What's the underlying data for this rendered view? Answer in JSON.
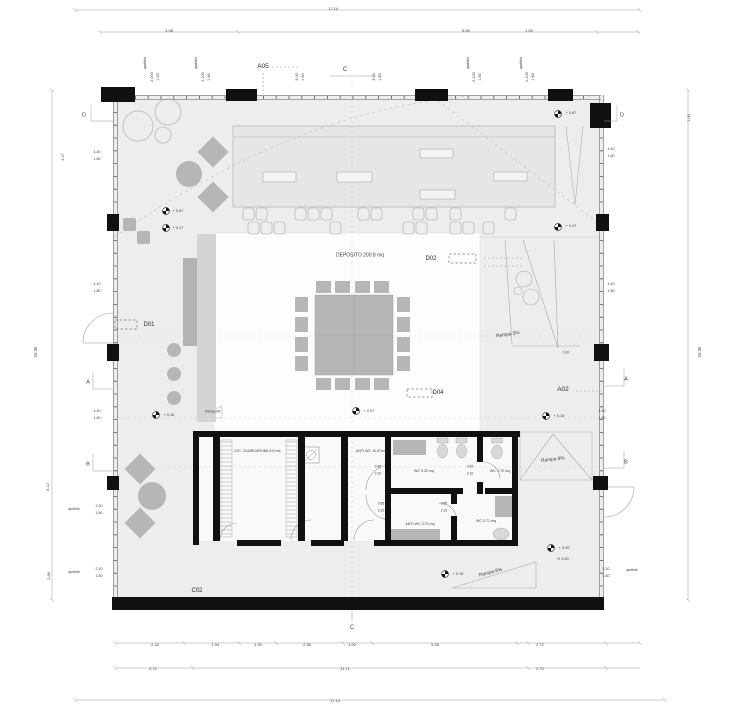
{
  "plan": {
    "colors": {
      "background": "#ffffff",
      "floor": "#ecedec",
      "wall": "#111111",
      "furniture": "#b5b7b6",
      "stage": "#e5e7e6",
      "text": "#3f3f3f"
    },
    "labels": [
      {
        "id": "dim-overall-top",
        "text": "17.14",
        "x": 333,
        "y": 9,
        "s": 4
      },
      {
        "id": "dim-top-3-08",
        "text": "3.08",
        "x": 169,
        "y": 31,
        "s": 4
      },
      {
        "id": "dim-top-8-55",
        "text": "8.55",
        "x": 466,
        "y": 31,
        "s": 4
      },
      {
        "id": "dim-top-1-00",
        "text": "1.00",
        "x": 529,
        "y": 31,
        "s": 4
      },
      {
        "id": "apribile-top-1",
        "text": "apribile",
        "x": 146,
        "y": 63,
        "s": 3.8,
        "rot": -90
      },
      {
        "id": "win-top-1a",
        "text": "2.000",
        "x": 153,
        "y": 77,
        "s": 3.8,
        "rot": -90
      },
      {
        "id": "win-top-1b",
        "text": "1.80",
        "x": 159,
        "y": 77,
        "s": 3.8,
        "rot": -90
      },
      {
        "id": "apribile-top-2",
        "text": "apribile",
        "x": 197,
        "y": 63,
        "s": 3.8,
        "rot": -90
      },
      {
        "id": "win-top-2a",
        "text": "2.100",
        "x": 204,
        "y": 77,
        "s": 3.8,
        "rot": -90
      },
      {
        "id": "win-top-2b",
        "text": "1.80",
        "x": 210,
        "y": 77,
        "s": 3.8,
        "rot": -90
      },
      {
        "id": "win-top-3a",
        "text": "3.00",
        "x": 298,
        "y": 77,
        "s": 3.8,
        "rot": -90
      },
      {
        "id": "win-top-3b",
        "text": "1.80",
        "x": 304,
        "y": 77,
        "s": 3.8,
        "rot": -90
      },
      {
        "id": "win-top-4a",
        "text": "3.00",
        "x": 375,
        "y": 77,
        "s": 3.8,
        "rot": -90
      },
      {
        "id": "win-top-4b",
        "text": "1.80",
        "x": 381,
        "y": 77,
        "s": 3.8,
        "rot": -90
      },
      {
        "id": "apribile-top-3",
        "text": "apribile",
        "x": 469,
        "y": 63,
        "s": 3.8,
        "rot": -90
      },
      {
        "id": "win-top-5a",
        "text": "2.100",
        "x": 475,
        "y": 77,
        "s": 3.8,
        "rot": -90
      },
      {
        "id": "win-top-5b",
        "text": "1.80",
        "x": 481,
        "y": 77,
        "s": 3.8,
        "rot": -90
      },
      {
        "id": "apribile-top-4",
        "text": "apribile",
        "x": 522,
        "y": 63,
        "s": 3.8,
        "rot": -90
      },
      {
        "id": "win-top-6a",
        "text": "2.100",
        "x": 528,
        "y": 77,
        "s": 3.8,
        "rot": -90
      },
      {
        "id": "win-top-6b",
        "text": "1.80",
        "x": 534,
        "y": 77,
        "s": 3.8,
        "rot": -90
      },
      {
        "id": "marker-a05",
        "text": "A05",
        "x": 263,
        "y": 67,
        "s": 6.5,
        "color": "#2b2b2b"
      },
      {
        "id": "marker-c-top",
        "text": "C",
        "x": 345,
        "y": 70,
        "s": 6
      },
      {
        "id": "marker-c-bottom",
        "text": "C",
        "x": 352,
        "y": 628,
        "s": 6
      },
      {
        "id": "marker-d-left",
        "text": "D",
        "x": 84,
        "y": 116,
        "s": 5.5
      },
      {
        "id": "marker-d-right",
        "text": "D",
        "x": 622,
        "y": 116,
        "s": 5.5
      },
      {
        "id": "marker-a-left",
        "text": "A",
        "x": 88,
        "y": 383,
        "s": 5.5
      },
      {
        "id": "marker-a-right",
        "text": "A",
        "x": 626,
        "y": 380,
        "s": 5.5
      },
      {
        "id": "marker-b-left",
        "text": "B",
        "x": 88,
        "y": 465,
        "s": 5.5
      },
      {
        "id": "marker-b-right",
        "text": "B",
        "x": 626,
        "y": 463,
        "s": 5.5
      },
      {
        "id": "callout-d01",
        "text": "D01",
        "x": 149,
        "y": 325,
        "s": 6,
        "color": "#2b2b2b"
      },
      {
        "id": "callout-d02",
        "text": "D02",
        "x": 431,
        "y": 259,
        "s": 6,
        "color": "#2b2b2b"
      },
      {
        "id": "callout-d04",
        "text": "D04",
        "x": 438,
        "y": 393,
        "s": 6,
        "color": "#2b2b2b"
      },
      {
        "id": "callout-a02",
        "text": "A02",
        "x": 563,
        "y": 390,
        "s": 6.5,
        "color": "#2b2b2b"
      },
      {
        "id": "callout-c02",
        "text": "C02",
        "x": 197,
        "y": 591,
        "s": 6,
        "color": "#2b2b2b"
      },
      {
        "id": "room-deposito",
        "text": "DEPOSITO 200.8 mq",
        "x": 360,
        "y": 256,
        "s": 5
      },
      {
        "id": "room-guardaroba",
        "text": "LOC. GUARDAROBA 9.6 mq",
        "x": 257,
        "y": 452,
        "s": 3.6
      },
      {
        "id": "room-anti-wc",
        "text": "ANTI WC 10.87mq",
        "x": 371,
        "y": 452,
        "s": 3.6
      },
      {
        "id": "room-wc-520",
        "text": "WC 5.20 mq",
        "x": 424,
        "y": 472,
        "s": 3.6
      },
      {
        "id": "room-wc-170",
        "text": "WC 1.70 mq",
        "x": 500,
        "y": 472,
        "s": 3.6
      },
      {
        "id": "room-anti-wc-370",
        "text": "ANTI-WC 3.70 mq",
        "x": 420,
        "y": 525,
        "s": 3.6
      },
      {
        "id": "room-wc-371",
        "text": "WC 3.71 mq",
        "x": 486,
        "y": 522,
        "s": 3.6
      },
      {
        "id": "door-dim-1a",
        "text": "0.85",
        "x": 378,
        "y": 467,
        "s": 3.4
      },
      {
        "id": "door-dim-1b",
        "text": "2.10",
        "x": 378,
        "y": 474,
        "s": 3.4
      },
      {
        "id": "door-dim-2a",
        "text": "0.85",
        "x": 470,
        "y": 467,
        "s": 3.4
      },
      {
        "id": "door-dim-2b",
        "text": "2.10",
        "x": 470,
        "y": 474,
        "s": 3.4
      },
      {
        "id": "door-dim-3a",
        "text": "0.85",
        "x": 381,
        "y": 504,
        "s": 3.4
      },
      {
        "id": "door-dim-3b",
        "text": "2.10",
        "x": 381,
        "y": 511,
        "s": 3.4
      },
      {
        "id": "door-dim-4a",
        "text": "0.85",
        "x": 444,
        "y": 504,
        "s": 3.4
      },
      {
        "id": "door-dim-4b",
        "text": "2.10",
        "x": 444,
        "y": 511,
        "s": 3.4
      },
      {
        "id": "ramp-5-label",
        "text": "Rampa 5%",
        "x": 508,
        "y": 336,
        "s": 4.8,
        "rot": -8
      },
      {
        "id": "ramp-8-right-label",
        "text": "Rampa 8%",
        "x": 553,
        "y": 461,
        "s": 4.8,
        "rot": -6
      },
      {
        "id": "ramp-8-bottom-label",
        "text": "Rampa 8%",
        "x": 491,
        "y": 574,
        "s": 4.8,
        "rot": -14
      },
      {
        "id": "ramp-8-small-label",
        "text": "Rampa 8%",
        "x": 213,
        "y": 412,
        "s": 3.2
      },
      {
        "id": "level-087-left",
        "text": "+ 0.87",
        "x": 178,
        "y": 212,
        "s": 3.8
      },
      {
        "id": "level-047-left",
        "text": "+ 0.47",
        "x": 178,
        "y": 229,
        "s": 3.8
      },
      {
        "id": "level-087-right",
        "text": "+ 0.87",
        "x": 571,
        "y": 114,
        "s": 3.8
      },
      {
        "id": "level-047-right",
        "text": "+ 0.47",
        "x": 571,
        "y": 227,
        "s": 3.8
      },
      {
        "id": "level-016-left",
        "text": "+ 0.16",
        "x": 169,
        "y": 416,
        "s": 3.8
      },
      {
        "id": "level-007-center",
        "text": "+ 0.07",
        "x": 369,
        "y": 412,
        "s": 3.8
      },
      {
        "id": "level-016-right",
        "text": "+ 0.16",
        "x": 559,
        "y": 417,
        "s": 3.8
      },
      {
        "id": "level-016-bottom",
        "text": "+ 0.16",
        "x": 458,
        "y": 575,
        "s": 3.8
      },
      {
        "id": "level-000",
        "text": "+ 0.00",
        "x": 564,
        "y": 549,
        "s": 3.8
      },
      {
        "id": "level-h350",
        "text": "H 3.50",
        "x": 563,
        "y": 560,
        "s": 3.8
      },
      {
        "id": "dim-left-427",
        "text": "4.27",
        "x": 64,
        "y": 157,
        "s": 3.8,
        "rot": -90
      },
      {
        "id": "win-left-1a",
        "text": "4.40",
        "x": 97,
        "y": 153,
        "s": 3.6
      },
      {
        "id": "win-left-1b",
        "text": "1.80",
        "x": 97,
        "y": 160,
        "s": 3.6
      },
      {
        "id": "win-left-2a",
        "text": "4.40",
        "x": 97,
        "y": 285,
        "s": 3.6
      },
      {
        "id": "win-left-2b",
        "text": "1.80",
        "x": 97,
        "y": 292,
        "s": 3.6
      },
      {
        "id": "win-left-3a",
        "text": "4.40",
        "x": 97,
        "y": 412,
        "s": 3.6
      },
      {
        "id": "win-left-3b",
        "text": "1.80",
        "x": 97,
        "y": 419,
        "s": 3.6
      },
      {
        "id": "dim-left-1630",
        "text": "16.30",
        "x": 36,
        "y": 352,
        "s": 4.2,
        "rot": -90
      },
      {
        "id": "dim-left-612",
        "text": "6.12",
        "x": 49,
        "y": 487,
        "s": 3.8,
        "rot": -90
      },
      {
        "id": "dim-left-288",
        "text": "2.88",
        "x": 50,
        "y": 576,
        "s": 3.8,
        "rot": -90
      },
      {
        "id": "apribile-left-1",
        "text": "apribile",
        "x": 74,
        "y": 510,
        "s": 3.6
      },
      {
        "id": "win-left-4a",
        "text": "2.20",
        "x": 99,
        "y": 507,
        "s": 3.6
      },
      {
        "id": "win-left-4b",
        "text": "1.80",
        "x": 99,
        "y": 514,
        "s": 3.6
      },
      {
        "id": "apribile-left-2",
        "text": "apribile",
        "x": 74,
        "y": 573,
        "s": 3.6
      },
      {
        "id": "win-left-5a",
        "text": "2.20",
        "x": 99,
        "y": 570,
        "s": 3.6
      },
      {
        "id": "win-left-5b",
        "text": "1.80",
        "x": 99,
        "y": 577,
        "s": 3.6
      },
      {
        "id": "dim-right-100",
        "text": "1.00",
        "x": 690,
        "y": 118,
        "s": 3.8,
        "rot": -90
      },
      {
        "id": "win-right-1a",
        "text": "4.40",
        "x": 611,
        "y": 150,
        "s": 3.6
      },
      {
        "id": "win-right-1b",
        "text": "1.80",
        "x": 611,
        "y": 157,
        "s": 3.6
      },
      {
        "id": "win-right-2a",
        "text": "4.40",
        "x": 611,
        "y": 285,
        "s": 3.6
      },
      {
        "id": "win-right-2b",
        "text": "1.80",
        "x": 611,
        "y": 292,
        "s": 3.6
      },
      {
        "id": "win-right-3a",
        "text": "4.40",
        "x": 602,
        "y": 412,
        "s": 3.6
      },
      {
        "id": "win-right-3b",
        "text": "1.80",
        "x": 602,
        "y": 419,
        "s": 3.6
      },
      {
        "id": "dim-right-1630",
        "text": "16.30",
        "x": 700,
        "y": 352,
        "s": 4.2,
        "rot": -90
      },
      {
        "id": "win-right-4a",
        "text": "2.20",
        "x": 606,
        "y": 570,
        "s": 3.6
      },
      {
        "id": "win-right-4b",
        "text": "1.80",
        "x": 606,
        "y": 577,
        "s": 3.6
      },
      {
        "id": "apribile-right-1",
        "text": "apribile",
        "x": 632,
        "y": 571,
        "s": 3.6
      },
      {
        "id": "dim-right-small-100",
        "text": "1.00",
        "x": 566,
        "y": 353,
        "s": 3.2
      },
      {
        "id": "dim-bot-242",
        "text": "2.42",
        "x": 155,
        "y": 645,
        "s": 4
      },
      {
        "id": "dim-bot-194",
        "text": "1.94",
        "x": 215,
        "y": 645,
        "s": 4
      },
      {
        "id": "dim-bot-130",
        "text": "1.30",
        "x": 258,
        "y": 645,
        "s": 4
      },
      {
        "id": "dim-bot-236",
        "text": "2.36",
        "x": 307,
        "y": 645,
        "s": 4
      },
      {
        "id": "dim-bot-100",
        "text": "1.00",
        "x": 352,
        "y": 645,
        "s": 4
      },
      {
        "id": "dim-bot-508",
        "text": "5.08",
        "x": 435,
        "y": 645,
        "s": 4
      },
      {
        "id": "dim-bot-272a",
        "text": "2.72",
        "x": 540,
        "y": 645,
        "s": 4
      },
      {
        "id": "dim-bot2-272a",
        "text": "2.72",
        "x": 153,
        "y": 669,
        "s": 4
      },
      {
        "id": "dim-bot2-1171",
        "text": "11.71",
        "x": 345,
        "y": 669,
        "s": 4
      },
      {
        "id": "dim-bot2-272b",
        "text": "2.72",
        "x": 540,
        "y": 669,
        "s": 4
      },
      {
        "id": "dim-overall-bottom",
        "text": "17.14",
        "x": 335,
        "y": 701,
        "s": 4
      }
    ]
  }
}
